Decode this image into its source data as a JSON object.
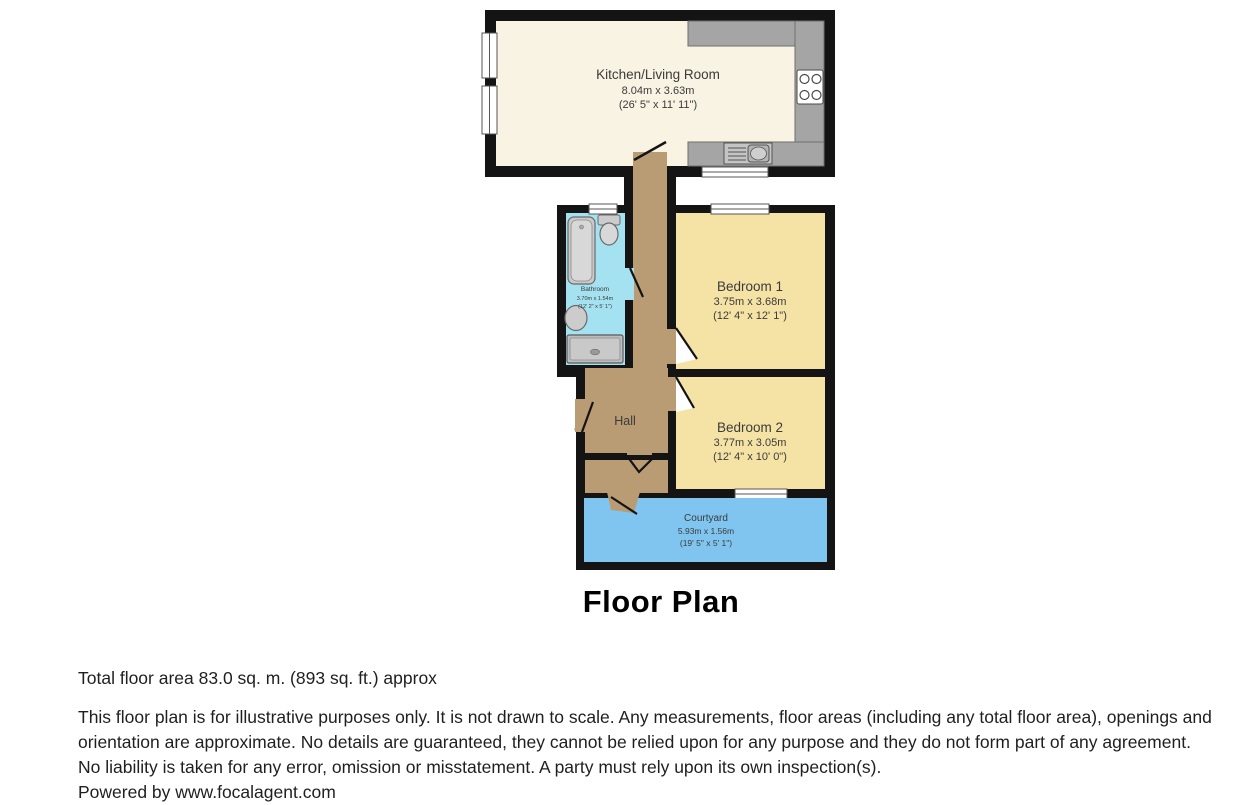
{
  "title": "Floor Plan",
  "rooms": {
    "kitchen": {
      "name": "Kitchen/Living Room",
      "metric": "8.04m x 3.63m",
      "imperial": "(26' 5\" x 11' 11\")"
    },
    "bathroom": {
      "name": "Bathroom",
      "metric": "3.70m x 1.54m",
      "imperial": "(12' 2\" x 5' 1\")"
    },
    "bedroom1": {
      "name": "Bedroom 1",
      "metric": "3.75m x 3.68m",
      "imperial": "(12' 4\" x 12' 1\")"
    },
    "bedroom2": {
      "name": "Bedroom 2",
      "metric": "3.77m x 3.05m",
      "imperial": "(12' 4\" x 10' 0\")"
    },
    "hall": {
      "name": "Hall"
    },
    "courtyard": {
      "name": "Courtyard",
      "metric": "5.93m x 1.56m",
      "imperial": "(19' 5\" x 5' 1\")"
    }
  },
  "footer": {
    "total_area": "Total floor area 83.0 sq. m. (893 sq. ft.) approx",
    "disclaimer": "This floor plan is for illustrative purposes only. It is not drawn to scale. Any measurements, floor areas (including any total floor area), openings and orientation are approximate. No details are guaranteed, they cannot be relied upon for any purpose and they do not form part of any agreement. No liability is taken for any error, omission or misstatement. A party must rely upon its own inspection(s).",
    "powered_by": "Powered by www.focalagent.com"
  },
  "colors": {
    "wall": "#141414",
    "kitchen_floor": "#F8F3E2",
    "bedroom_floor": "#F5E3A6",
    "hall_floor": "#B99C73",
    "bathroom_floor": "#A5E2F1",
    "courtyard_floor": "#7FC5F0",
    "counter": "#A5A5A5"
  }
}
